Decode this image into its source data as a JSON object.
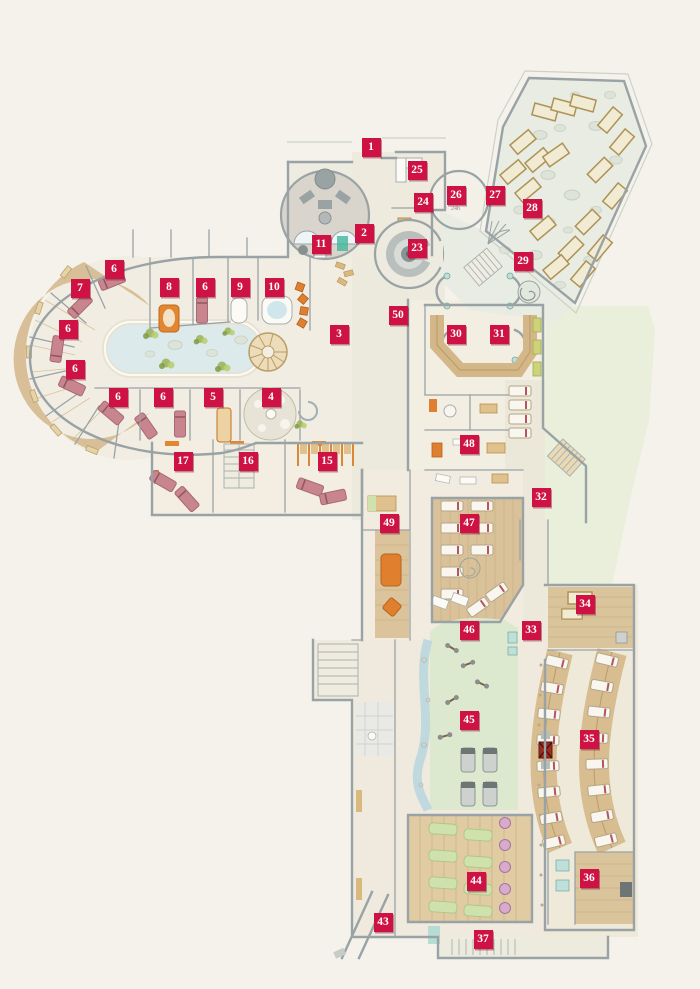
{
  "page": {
    "background": "#f5f2ec"
  },
  "plan": {
    "type": "spa-wellness-floor-plan",
    "marker_color": "#ce1243",
    "marker_text_color": "#ffffff",
    "room26_label": "24h",
    "markers": [
      {
        "n": "1",
        "x": 371,
        "y": 147
      },
      {
        "n": "2",
        "x": 364,
        "y": 233
      },
      {
        "n": "3",
        "x": 339,
        "y": 334
      },
      {
        "n": "4",
        "x": 271,
        "y": 397
      },
      {
        "n": "5",
        "x": 213,
        "y": 397
      },
      {
        "n": "6",
        "x": 114,
        "y": 269
      },
      {
        "n": "6",
        "x": 205,
        "y": 287
      },
      {
        "n": "6",
        "x": 68,
        "y": 329
      },
      {
        "n": "6",
        "x": 75,
        "y": 369
      },
      {
        "n": "6",
        "x": 118,
        "y": 397
      },
      {
        "n": "6",
        "x": 163,
        "y": 397
      },
      {
        "n": "7",
        "x": 80,
        "y": 288
      },
      {
        "n": "8",
        "x": 169,
        "y": 287
      },
      {
        "n": "9",
        "x": 240,
        "y": 287
      },
      {
        "n": "10",
        "x": 274,
        "y": 287
      },
      {
        "n": "11",
        "x": 321,
        "y": 244
      },
      {
        "n": "15",
        "x": 327,
        "y": 461
      },
      {
        "n": "16",
        "x": 248,
        "y": 461
      },
      {
        "n": "17",
        "x": 183,
        "y": 461
      },
      {
        "n": "23",
        "x": 417,
        "y": 248
      },
      {
        "n": "24",
        "x": 423,
        "y": 202
      },
      {
        "n": "25",
        "x": 417,
        "y": 170
      },
      {
        "n": "26",
        "x": 456,
        "y": 195
      },
      {
        "n": "27",
        "x": 495,
        "y": 195
      },
      {
        "n": "28",
        "x": 532,
        "y": 208
      },
      {
        "n": "29",
        "x": 523,
        "y": 261
      },
      {
        "n": "30",
        "x": 456,
        "y": 334
      },
      {
        "n": "31",
        "x": 499,
        "y": 334
      },
      {
        "n": "32",
        "x": 541,
        "y": 497
      },
      {
        "n": "33",
        "x": 531,
        "y": 630
      },
      {
        "n": "34",
        "x": 585,
        "y": 604
      },
      {
        "n": "35",
        "x": 589,
        "y": 739
      },
      {
        "n": "36",
        "x": 589,
        "y": 878
      },
      {
        "n": "37",
        "x": 483,
        "y": 939
      },
      {
        "n": "43",
        "x": 383,
        "y": 922
      },
      {
        "n": "44",
        "x": 476,
        "y": 881
      },
      {
        "n": "45",
        "x": 469,
        "y": 720
      },
      {
        "n": "46",
        "x": 469,
        "y": 630
      },
      {
        "n": "47",
        "x": 469,
        "y": 523
      },
      {
        "n": "48",
        "x": 469,
        "y": 444
      },
      {
        "n": "49",
        "x": 389,
        "y": 523
      },
      {
        "n": "50",
        "x": 398,
        "y": 315
      }
    ]
  }
}
